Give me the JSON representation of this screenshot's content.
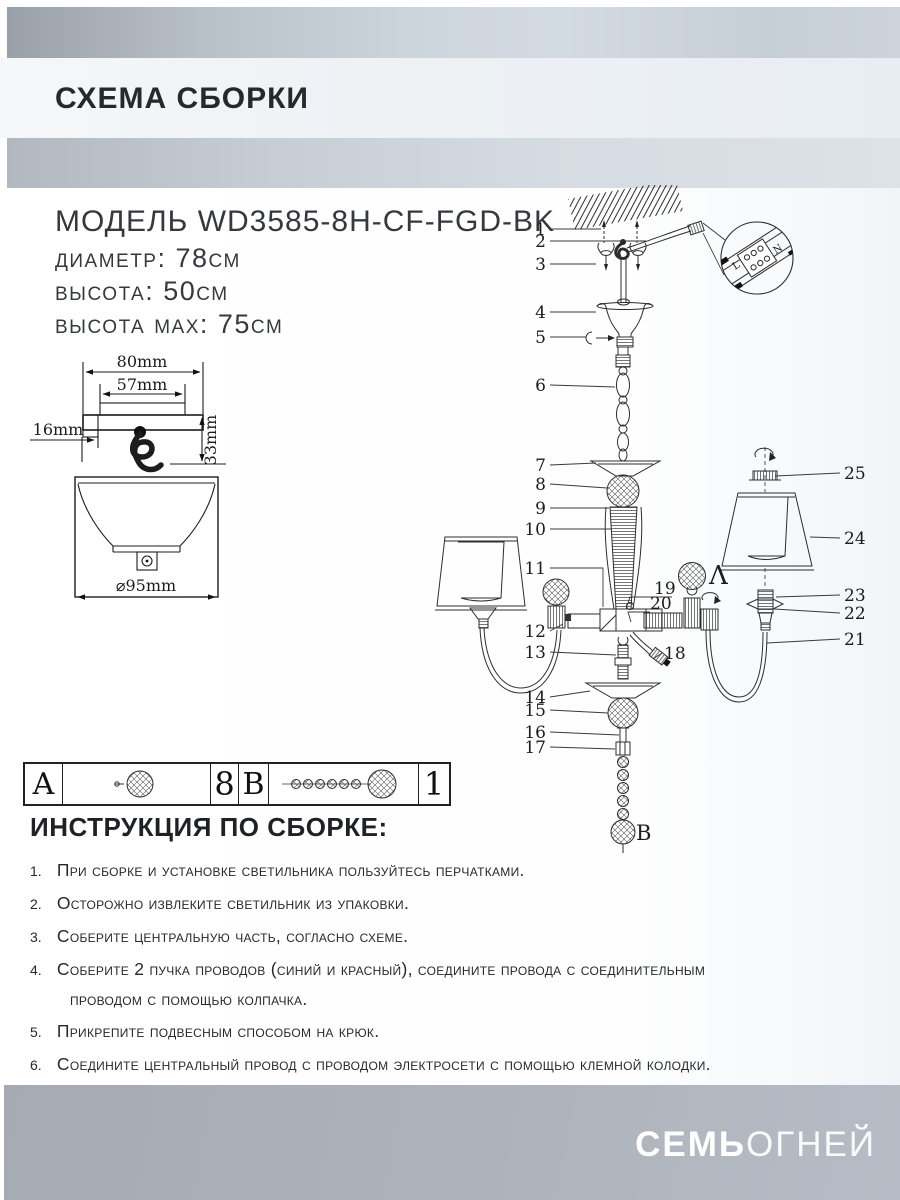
{
  "header": {
    "title": "СХЕМА СБОРКИ"
  },
  "model": {
    "name_line": "МОДЕЛЬ WD3585-8H-CF-FGD-BK",
    "diameter": "диаметр: 78см",
    "height": "высота: 50см",
    "height_max": "высота max: 75см"
  },
  "dims": {
    "w80": "80mm",
    "w57": "57mm",
    "o16": "16mm",
    "h33": "33mm",
    "d95": "⌀95mm"
  },
  "diagram": {
    "n1": "1",
    "n2": "2",
    "n3": "3",
    "n4": "4",
    "n5": "5",
    "n6": "6",
    "n7": "7",
    "n8": "8",
    "n9": "9",
    "n10": "10",
    "n11": "11",
    "n12": "12",
    "n13": "13",
    "n14": "14",
    "n15": "15",
    "n16": "16",
    "n17": "17",
    "n18": "18",
    "n19": "19",
    "n20": "20",
    "n21": "21",
    "n22": "22",
    "n23": "23",
    "n24": "24",
    "n25": "25",
    "label_a": "Λ",
    "label_b": "B",
    "terminal_l": "L",
    "terminal_n": "N"
  },
  "parts_table": {
    "rows": [
      {
        "letter": "A",
        "qty": "8"
      },
      {
        "letter": "B",
        "qty": "1"
      }
    ]
  },
  "instructions": {
    "title": "ИНСТРУКЦИЯ ПО СБОРКЕ:",
    "items": [
      {
        "num": "1.",
        "text": "При сборке и установке светильника пользуйтесь перчатками."
      },
      {
        "num": "2.",
        "text": "Осторожно извлеките светильник из упаковки."
      },
      {
        "num": "3.",
        "text": "Соберите центральную часть, согласно схеме."
      },
      {
        "num": "4.",
        "text": "Соберите 2 пучка проводов (синий и красный), соедините провода с соединительным",
        "text2": "проводом с помощью колпачка."
      },
      {
        "num": "5.",
        "text": "Прикрепите подвесным способом на крюк."
      },
      {
        "num": "6.",
        "text": "Соедините центральный провод с проводом электросети с помощью клемной колодки."
      }
    ]
  },
  "footer": {
    "brand_bold": "СЕМЬ",
    "brand_light": "ОГНЕЙ"
  },
  "colors": {
    "band_dark": "#9aa0a7",
    "band_light": "#d3dae2",
    "header_bg": "#eef2f5",
    "footer_gray": "#abb0b8",
    "text_dark": "#26282c",
    "line": "#2d2d2d"
  }
}
